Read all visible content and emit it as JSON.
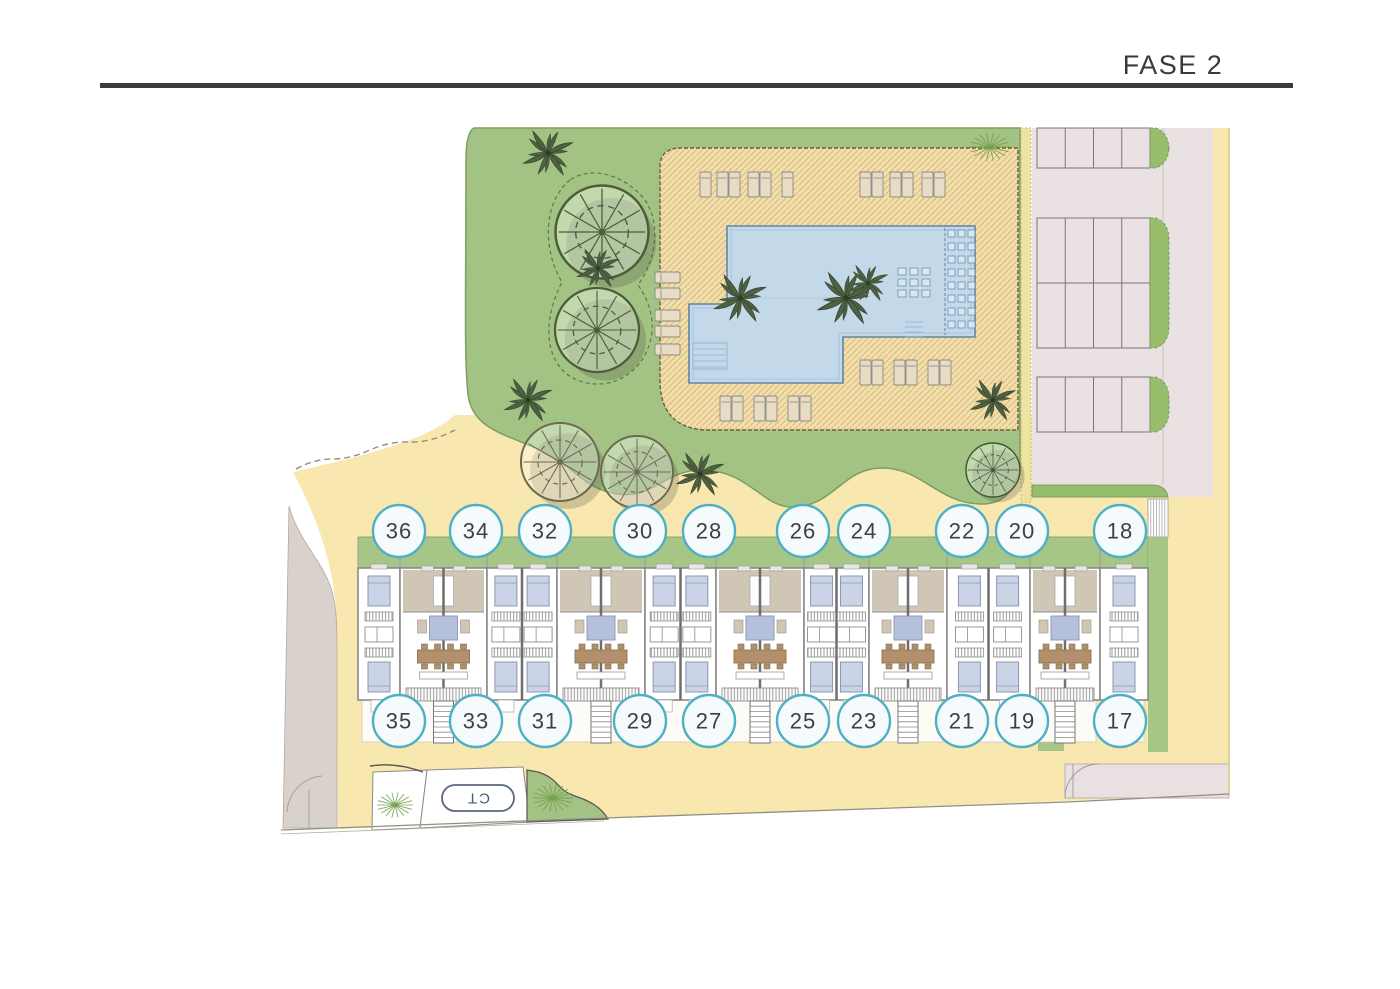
{
  "header": {
    "title": "FASE 2"
  },
  "plan": {
    "lots_top": [
      "36",
      "34",
      "32",
      "30",
      "28",
      "26",
      "24",
      "22",
      "20",
      "18"
    ],
    "lots_bottom": [
      "35",
      "33",
      "31",
      "29",
      "27",
      "25",
      "23",
      "21",
      "19",
      "17"
    ],
    "transformer_label": "CT",
    "colors": {
      "sand": "#F9E7B0",
      "garden": "#A2C383",
      "garden_edge": "#7F9E5F",
      "deck": "#F2DFAC",
      "deck_hatch": "#DCBE82",
      "deck_edge": "#6d5f3e",
      "pool": "#C3D9E9",
      "pool_border": "#5F86A5",
      "parking": "#EAE2E2",
      "parking_line": "#777777",
      "parking_green": "#96BE6C",
      "houses_green": "#A5C687",
      "terrace": "#CFC6B5",
      "wall": "#8a8a8a",
      "bed": "#CBD4E6",
      "bed_border": "#8C97B0",
      "table": "#B2906C",
      "circle_border": "#4FB0C4",
      "circle_fill": "#F5FBFD",
      "number_text": "#3f3f3f",
      "road_left": "#D9D1CC",
      "road_bottom": "#E9E1E1",
      "ct_border": "#5A6880",
      "ct_text": "#4A5878",
      "boundary": "#90907e"
    }
  }
}
